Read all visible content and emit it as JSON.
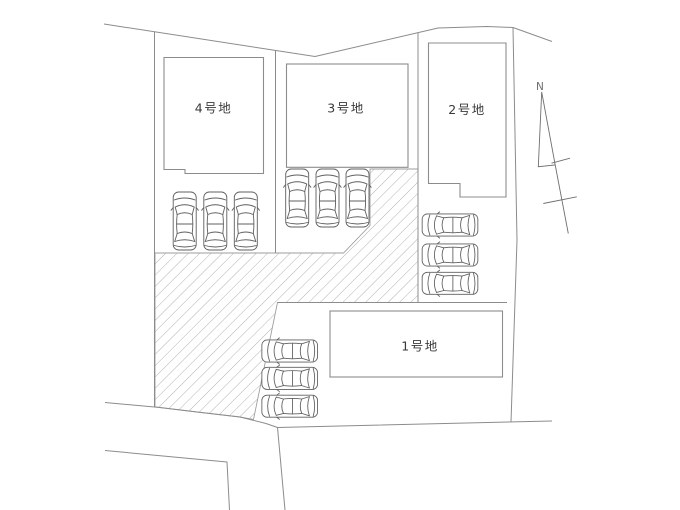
{
  "diagram": {
    "type": "residential-site-plan",
    "background": "#ffffff",
    "line_color": "#8c8c8c",
    "text_color": "#3a3a3a",
    "hatch_color": "#9e9e9e",
    "car_line_color": "#5f5f5f",
    "compass_color": "#6f6f6f"
  },
  "lots": [
    {
      "label": "1号地",
      "parked_cars": 3
    },
    {
      "label": "2号地",
      "parked_cars": 3
    },
    {
      "label": "3号地",
      "parked_cars": 3
    },
    {
      "label": "4号地",
      "parked_cars": 3
    }
  ],
  "compass": {
    "label": "N"
  }
}
